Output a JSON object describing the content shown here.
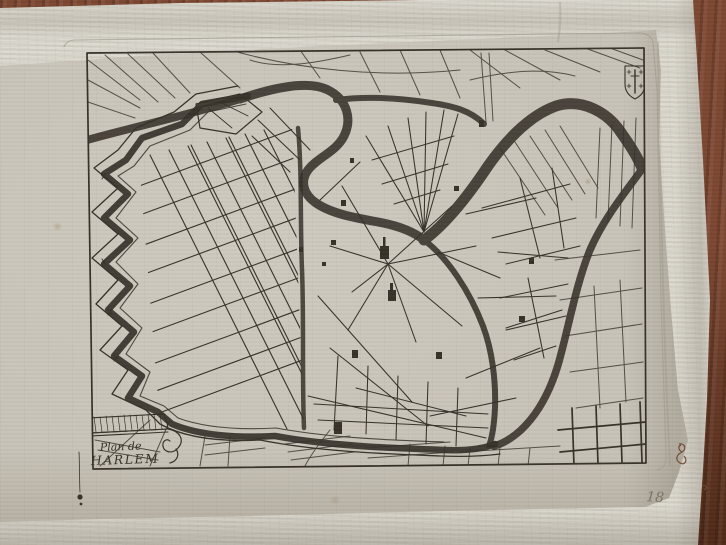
{
  "photo": {
    "subject": "Antique engraved town plan of Haarlem photographed on a wooden table, lying over the pages of an open book"
  },
  "cartouche": {
    "line1": "Plan de",
    "line2": "HARLEM"
  },
  "annotations": {
    "page_number": "18"
  },
  "colors": {
    "ink": "#353028",
    "ink_soft": "#57514597",
    "plate_mark": "#a39d90",
    "paper": "#c8c3b8",
    "paper_bright": "#dad7cd",
    "paper_shadow": "#a9a396",
    "wood": "#7b4630",
    "wood_dark": "#4e2817",
    "pencil": "#7b7567",
    "brown_ink": "#6f4b32"
  }
}
